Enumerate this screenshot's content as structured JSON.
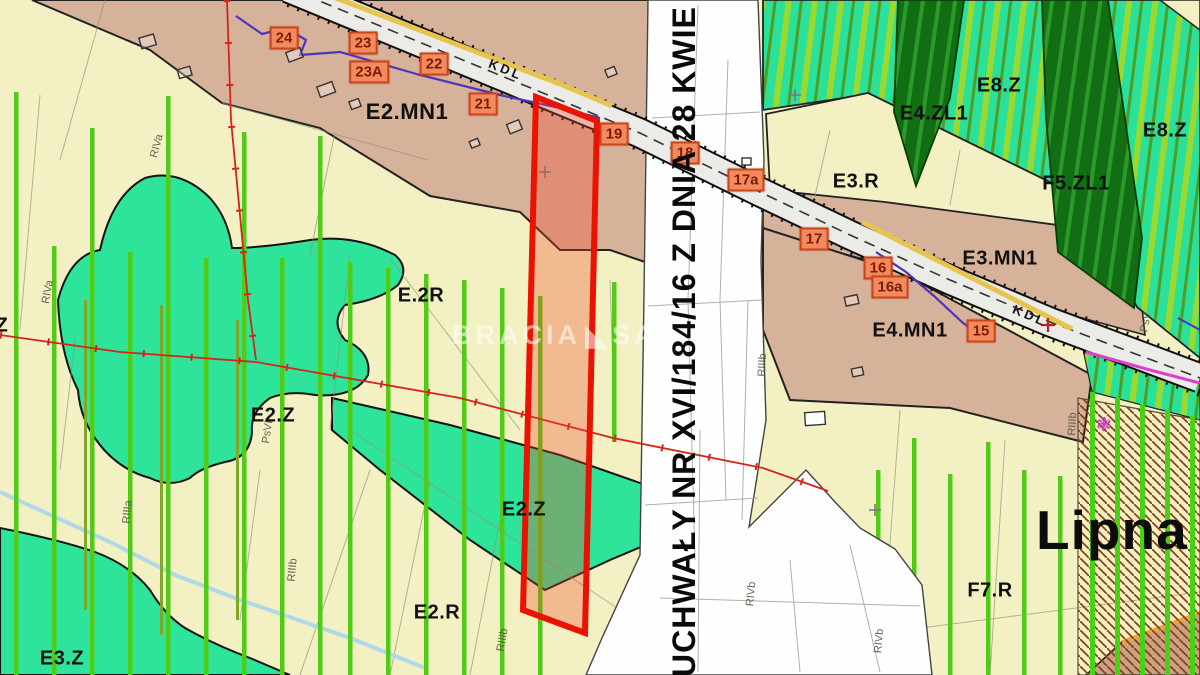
{
  "map": {
    "place_name": "Lipna",
    "vertical_note": "UCHWAŁY NR XVI/184/16 Z DNIA 28 KWIE",
    "road_label": "KDL",
    "watermark": {
      "left": "BRACIA",
      "logo": "triangle",
      "right": "SA"
    },
    "zones": [
      {
        "label": "E2.MN1"
      },
      {
        "label": "E.2R"
      },
      {
        "label": "E2.Z"
      },
      {
        "label": "E2.Z"
      },
      {
        "label": "E2.R"
      },
      {
        "label": "E3.Z"
      },
      {
        "label": "E3.R"
      },
      {
        "label": "E3.MN1"
      },
      {
        "label": "E4.MN1"
      },
      {
        "label": "E4.ZL1"
      },
      {
        "label": "F5.ZL1"
      },
      {
        "label": "E8.Z"
      },
      {
        "label": "E8.Z"
      },
      {
        "label": "F7.R"
      },
      {
        "label": "Z"
      }
    ],
    "markers": [
      {
        "label": "24"
      },
      {
        "label": "23"
      },
      {
        "label": "23A"
      },
      {
        "label": "22"
      },
      {
        "label": "21"
      },
      {
        "label": "19"
      },
      {
        "label": "18"
      },
      {
        "label": "17a"
      },
      {
        "label": "17"
      },
      {
        "label": "16"
      },
      {
        "label": "16a"
      },
      {
        "label": "15"
      }
    ],
    "soil_labels": [
      {
        "label": "RIVa"
      },
      {
        "label": "RIVa"
      },
      {
        "label": "PsVI"
      },
      {
        "label": "RIIIa"
      },
      {
        "label": "RIIIb"
      },
      {
        "label": "RIIIb"
      },
      {
        "label": "RIIIb"
      },
      {
        "label": "RIVb"
      },
      {
        "label": "RIVb"
      },
      {
        "label": "PsV"
      },
      {
        "label": "RIIIb"
      }
    ],
    "colors": {
      "background_cream": "#F3F0C3",
      "zone_tan": "#D7B29B",
      "zone_teal_green": "#2EE49A",
      "forest_dark_green": "#126E12",
      "stripe_green": "#52CB17",
      "stripe_olive": "#7FA72B",
      "road_yellow": "#E7C44D",
      "parcel_red": "#EA1200",
      "marker_bg": "#F18B5F",
      "marker_border": "#CC4417",
      "hatch_brown": "#8C3D16",
      "utility_purple": "#4A35BB",
      "utility_magenta": "#DD3ECE",
      "stream_blue": "#AFD8E8"
    }
  }
}
